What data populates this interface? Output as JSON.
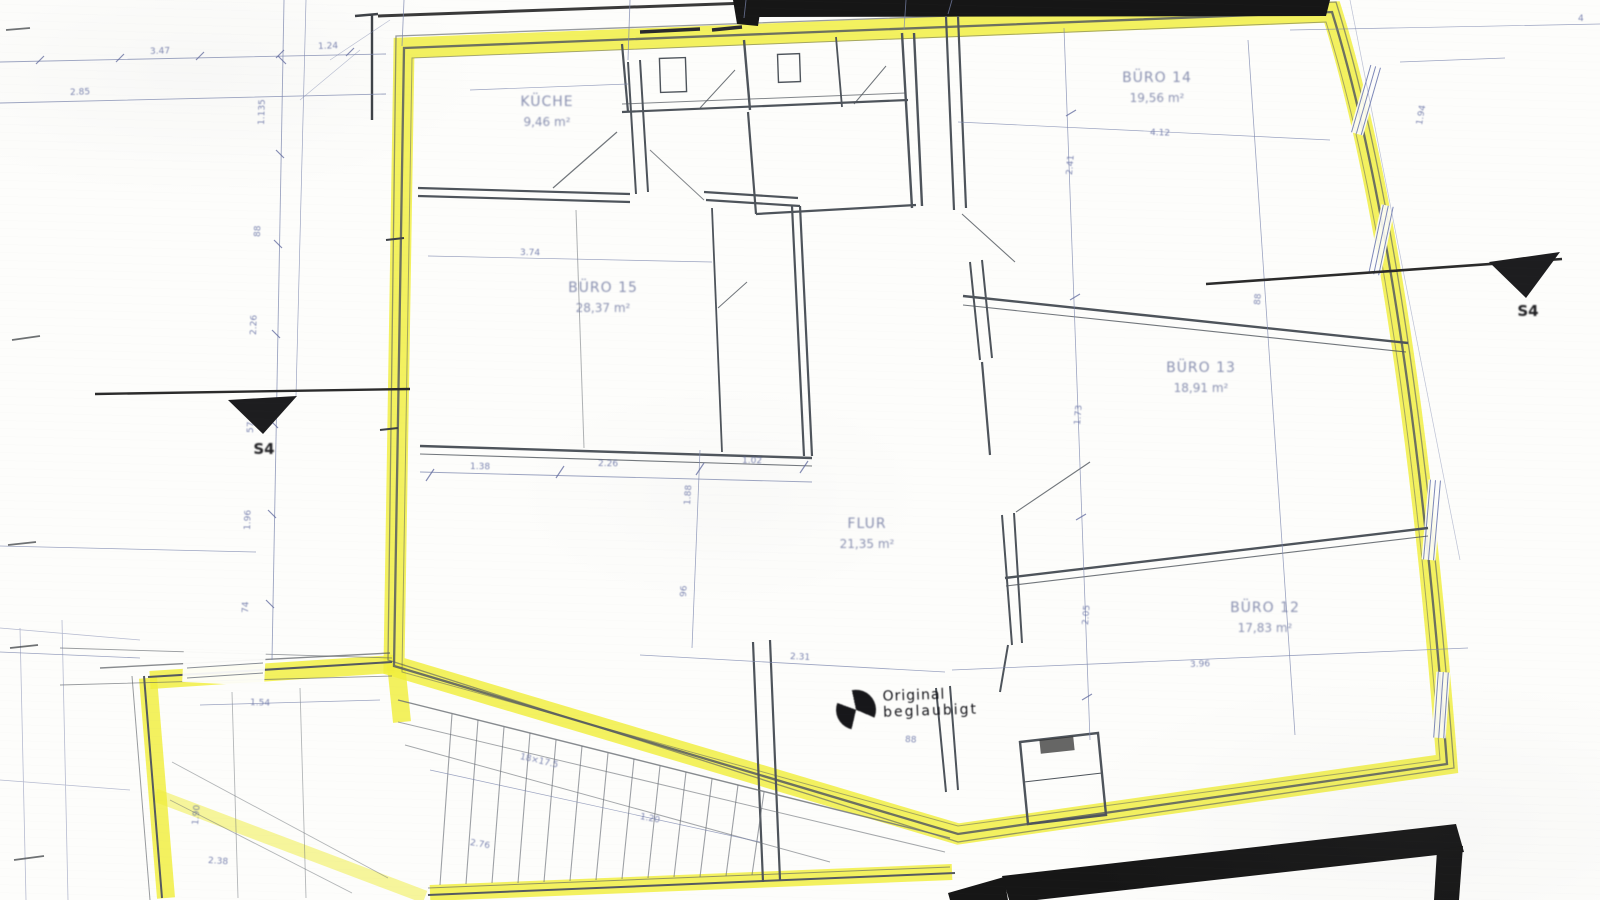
{
  "document": {
    "type": "scanned architectural floor plan with unit outline highlighted",
    "highlight_color": "#f0ee3c",
    "wall_color": "#4e545b",
    "dim_color": "#6b76a6",
    "black_band_color": "#161616",
    "paper_color": "#fdfdfb"
  },
  "rooms": [
    {
      "id": "kueche",
      "name": "KÜCHE",
      "area": "9,46 m²"
    },
    {
      "id": "buero-15",
      "name": "BÜRO 15",
      "area": "28,37 m²"
    },
    {
      "id": "buero-14",
      "name": "BÜRO 14",
      "area": "19,56 m²"
    },
    {
      "id": "buero-13",
      "name": "BÜRO 13",
      "area": "18,91 m²"
    },
    {
      "id": "buero-12",
      "name": "BÜRO 12",
      "area": "17,83 m²"
    },
    {
      "id": "flur",
      "name": "FLUR",
      "area": "21,35 m²"
    }
  ],
  "section_markers": {
    "left": {
      "label": "S4"
    },
    "right": {
      "label": "S4"
    }
  },
  "stamp": {
    "symbol": "quartered-circle-survey-mark",
    "line1": "Original",
    "line2": "beglaubigt"
  },
  "margin_mark": "4",
  "dimensions": [
    {
      "x": 150,
      "y": 47,
      "r": -2,
      "t": "3.47"
    },
    {
      "x": 318,
      "y": 42,
      "r": -2,
      "t": "1.24"
    },
    {
      "x": 70,
      "y": 88,
      "r": -2,
      "t": "2.85"
    },
    {
      "x": 262,
      "y": 120,
      "r": -88,
      "t": "1.135"
    },
    {
      "x": 258,
      "y": 232,
      "r": -88,
      "t": "88"
    },
    {
      "x": 254,
      "y": 330,
      "r": -88,
      "t": "2.26"
    },
    {
      "x": 251,
      "y": 428,
      "r": -88,
      "t": "57"
    },
    {
      "x": 248,
      "y": 525,
      "r": -88,
      "t": "1.96"
    },
    {
      "x": 246,
      "y": 608,
      "r": -88,
      "t": "74"
    },
    {
      "x": 470,
      "y": 462,
      "r": 1,
      "t": "1.38"
    },
    {
      "x": 598,
      "y": 459,
      "r": 1,
      "t": "2.26"
    },
    {
      "x": 742,
      "y": 456,
      "r": 1,
      "t": "1.02"
    },
    {
      "x": 520,
      "y": 248,
      "r": 1,
      "t": "3.74"
    },
    {
      "x": 688,
      "y": 500,
      "r": -86,
      "t": "1.88"
    },
    {
      "x": 684,
      "y": 592,
      "r": -86,
      "t": "96"
    },
    {
      "x": 790,
      "y": 652,
      "r": 3,
      "t": "2.31"
    },
    {
      "x": 1070,
      "y": 170,
      "r": -85,
      "t": "2.41"
    },
    {
      "x": 1078,
      "y": 420,
      "r": -85,
      "t": "1.73"
    },
    {
      "x": 1086,
      "y": 620,
      "r": -85,
      "t": "2.05"
    },
    {
      "x": 1150,
      "y": 128,
      "r": 2,
      "t": "4.12"
    },
    {
      "x": 1258,
      "y": 300,
      "r": -85,
      "t": "88"
    },
    {
      "x": 1190,
      "y": 660,
      "r": -2,
      "t": "3.96"
    },
    {
      "x": 1420,
      "y": 120,
      "r": -80,
      "t": "1.94"
    },
    {
      "x": 520,
      "y": 752,
      "r": 13,
      "t": "18×17.5"
    },
    {
      "x": 470,
      "y": 838,
      "r": 10,
      "t": "2.76"
    },
    {
      "x": 640,
      "y": 812,
      "r": 11,
      "t": "1.20"
    },
    {
      "x": 250,
      "y": 698,
      "r": 2,
      "t": "1.54"
    },
    {
      "x": 196,
      "y": 820,
      "r": -85,
      "t": "1.90"
    },
    {
      "x": 208,
      "y": 856,
      "r": 4,
      "t": "2.38"
    },
    {
      "x": 905,
      "y": 735,
      "r": 3,
      "t": "88"
    },
    {
      "x": 1578,
      "y": 14,
      "r": 0,
      "t": "4"
    }
  ]
}
